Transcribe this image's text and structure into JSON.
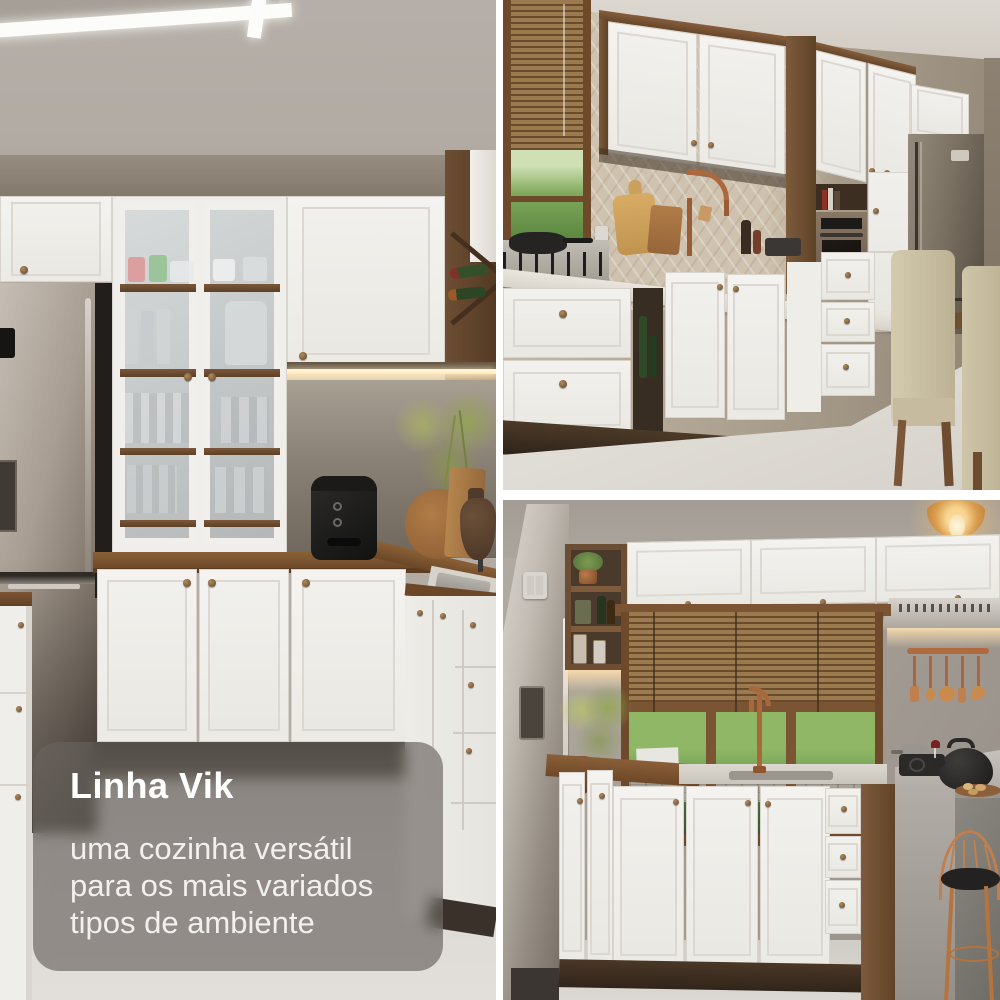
{
  "overlay": {
    "title": "Linha Vik",
    "subtitle_lines": [
      "uma cozinha versátil",
      "para os mais variados",
      "tipos de ambiente"
    ]
  },
  "palette": {
    "frame_background": "#ffffff",
    "overlay_background": "rgba(104,99,94,0.66)",
    "overlay_title_color": "#ffffff",
    "overlay_text_color": "#f2f0ee",
    "cabinet_white": "#f2f1ee",
    "wood_brown": "#7a573a",
    "counter_wood": "#8a6036",
    "copper_accent": "#b06a3e",
    "stainless_gray": "#a9a29a",
    "wall_taupe": "#9a8e80",
    "foliage_green": "#6f9c4f",
    "floor_light": "#dad7d2",
    "led_warm": "#ffe9bd"
  }
}
